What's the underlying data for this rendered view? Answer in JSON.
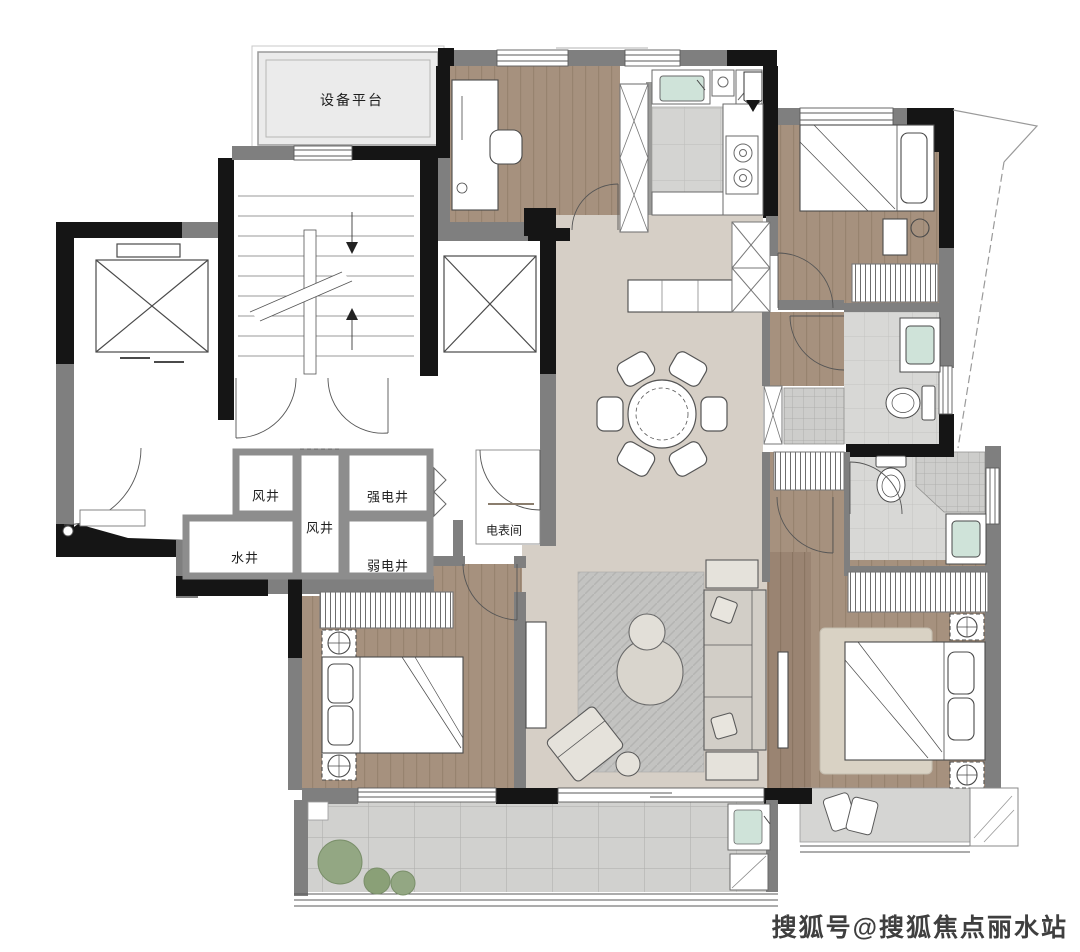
{
  "plan": {
    "labels": {
      "equipment_platform": "设备平台",
      "wind_shaft_upper": "风井",
      "wind_shaft_lower": "风井",
      "strong_electric_shaft": "强电井",
      "water_shaft": "水井",
      "weak_electric_shaft": "弱电井",
      "meter_room": "电表间"
    },
    "watermark": "搜狐号@搜狐焦点丽水站",
    "colors": {
      "wall_main": "#151515",
      "wall_secondary": "#7f7f7f",
      "shaft_wall": "#8d8d8d",
      "wood_floor": "#a6917e",
      "feature_wall_wood": "#9a8472",
      "living_floor": "#d6cfc6",
      "tile_floor": "#d4d4d2",
      "balcony_tile": "#d1d1cf",
      "platform_fill": "#ebebeb",
      "sink_mint": "#cfe3d9",
      "plant_green": "#93a783",
      "rug_gray": "#c3c3c1"
    }
  }
}
